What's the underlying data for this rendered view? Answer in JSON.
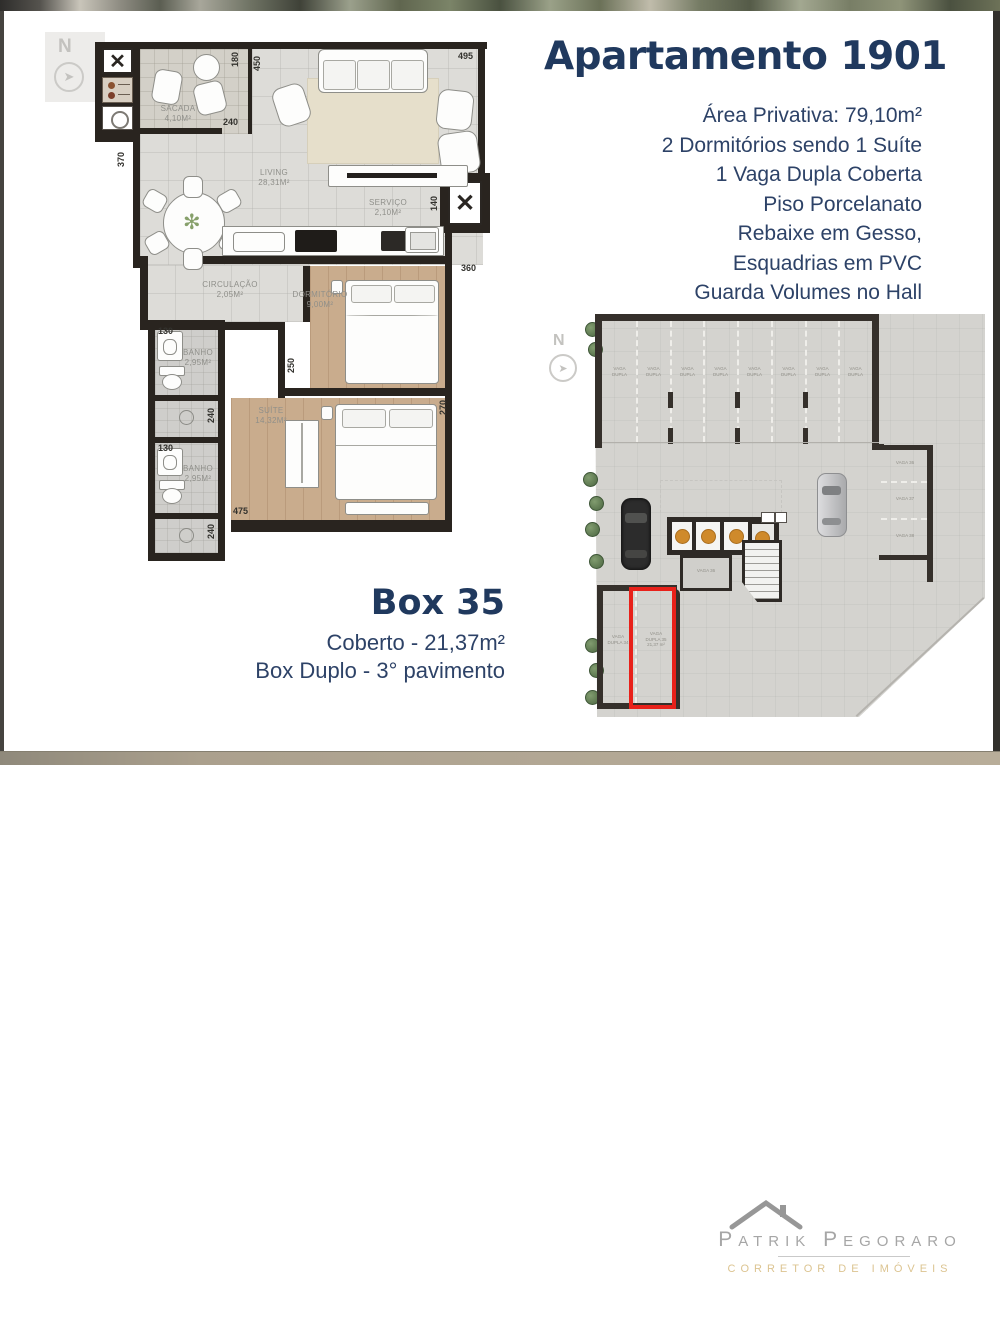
{
  "header": {
    "title": "Apartamento 1901",
    "details": [
      "Área Privativa: 79,10m²",
      "2 Dormitórios sendo 1 Suíte",
      "1 Vaga Dupla Coberta",
      "Piso Porcelanato",
      "Rebaixe em Gesso,",
      "Esquadrias em PVC",
      "Guarda Volumes no Hall"
    ]
  },
  "floor_plan": {
    "north": "N",
    "rooms": {
      "sacada": "SACADA\n4,10m²",
      "living": "LIVING\n28,31m²",
      "servico": "SERVIÇO\n2,10m²",
      "circulacao": "CIRCULAÇÃO\n2,05m²",
      "dormitorio": "DORMITÓRIO\n9,00m²",
      "banho1": "BANHO\n2,95m²",
      "banho2": "BANHO\n2,95m²",
      "suite": "SUÍTE\n14,32m²"
    },
    "dims": {
      "d180": "180",
      "d450": "450",
      "d495": "495",
      "d240_sacada": "240",
      "d370": "370",
      "d140": "140",
      "d360": "360",
      "d130_a": "130",
      "d240_a": "240",
      "d250": "250",
      "d270": "270",
      "d130_b": "130",
      "d240_b": "240",
      "d475": "475"
    }
  },
  "box_info": {
    "title": "Box 35",
    "coberto": "Coberto - 21,37m²",
    "duplo": "Box Duplo - 3° pavimento"
  },
  "garage": {
    "north": "N",
    "top_stalls": [
      "VAGA\nDUPLA",
      "VAGA\nDUPLA",
      "VAGA\nDUPLA",
      "VAGA\nDUPLA",
      "VAGA\nDUPLA",
      "VAGA\nDUPLA",
      "VAGA\nDUPLA",
      "VAGA\nDUPLA"
    ],
    "side_stalls": [
      "VAGA 36",
      "VAGA 37",
      "VAGA 38"
    ],
    "center_room": "VAGA 36",
    "stall_34": "VAGA\nDUPLA 34",
    "stall_35": "VAGA\nDUPLA 35\n21,37 m²"
  },
  "logo": {
    "name": "Patrik Pegoraro",
    "tagline": "CORRETOR DE IMÓVEIS"
  }
}
